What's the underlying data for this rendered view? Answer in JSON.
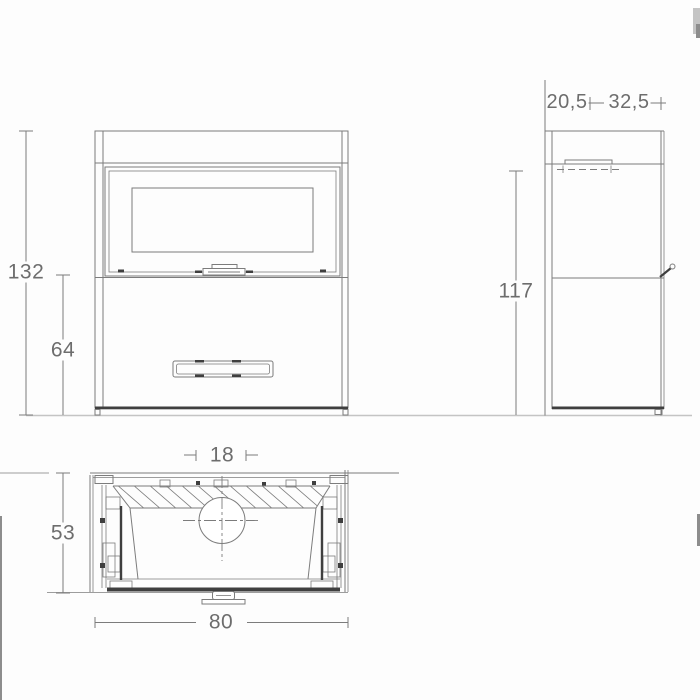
{
  "drawing": {
    "type": "technical-dimension-drawing",
    "views": {
      "front": {
        "label": "front-view"
      },
      "side": {
        "label": "side-view"
      },
      "plan": {
        "label": "plan-view"
      }
    },
    "dimensions": {
      "front_total_height": "132",
      "front_lower_height": "64",
      "side_top_front_depth": "20,5",
      "side_top_rear_depth": "32,5",
      "side_body_height": "117",
      "plan_flue_diameter": "18",
      "plan_depth": "53",
      "plan_width": "80"
    },
    "colors": {
      "line": "#7c7c7c",
      "dark": "#3f3f3f",
      "text": "#6d6d6d",
      "ground": "#c4c4c4",
      "bg": "#fdfdfd",
      "edge_mark": "#8d8d8d"
    }
  }
}
